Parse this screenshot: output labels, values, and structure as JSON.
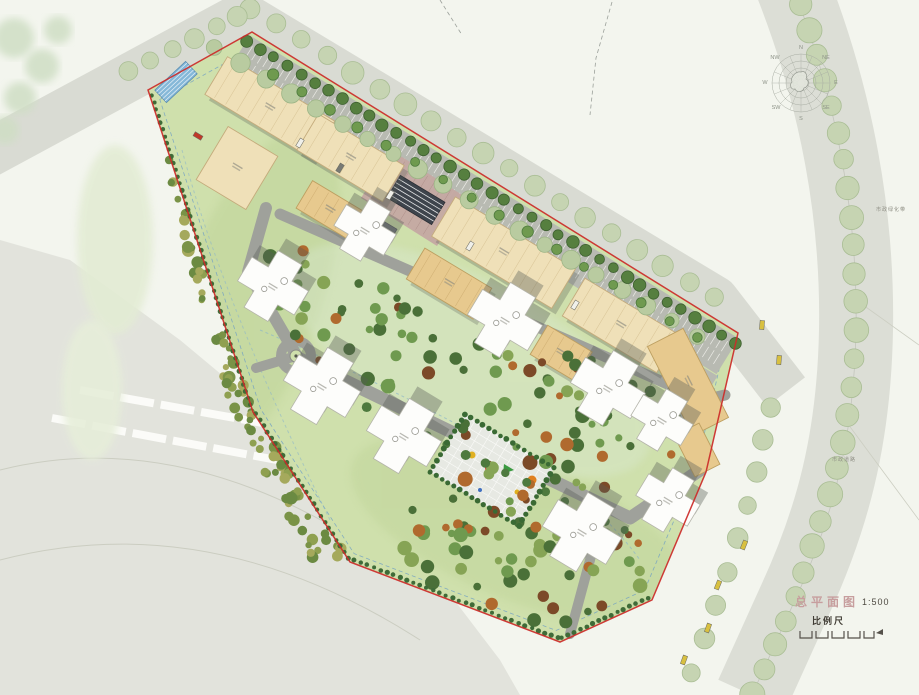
{
  "drawing": {
    "title": "总平面图",
    "scale": "1:500",
    "scale_bar_label": "比例尺"
  },
  "annotations": {
    "greenbelt": "市政绿化带",
    "road": "市政道路"
  },
  "compass": {
    "directions": [
      "N",
      "NE",
      "E",
      "SE",
      "S",
      "SW",
      "W",
      "NW"
    ]
  },
  "colors": {
    "boundary_red": "#cc2a28",
    "setback_blue": "#6f9fc4",
    "site_green": "#cfe0ac",
    "site_green_dark": "#c0d49a",
    "context_road": "#d9dbd3",
    "outer_road": "#dcded6",
    "bottom_road": "#e2e3dc",
    "inner_road": "#9fa19b",
    "parking": "#b8bab2",
    "commercial_light": "#efe0b8",
    "commercial_light_edge": "#c4ab7c",
    "commercial_dark": "#e7c98e",
    "commercial_dark_edge": "#bd9f60",
    "tower_white": "#fdfdfb",
    "tower_edge": "#b4b4aa",
    "shadow": "#5a5f58",
    "tree_dark": "#4a7038",
    "tree_mid": "#6f9a4f",
    "tree_light": "#86a455",
    "tree_olive": "#8fa050",
    "tree_accent": "#b06a2e",
    "tree_pale": "#c6d4b2",
    "tree_pale_edge": "#a9bd94",
    "hedge": "#3f6b38",
    "canopy_dark": "#3e444c",
    "canopy_blue": "#85b8d8",
    "plaza_red": "#c4a8a2",
    "play_plaza": "#e7e9e3",
    "path_blue": "#8fb8c8",
    "car_yellow": "#d8c040",
    "car_red": "#c03828"
  }
}
